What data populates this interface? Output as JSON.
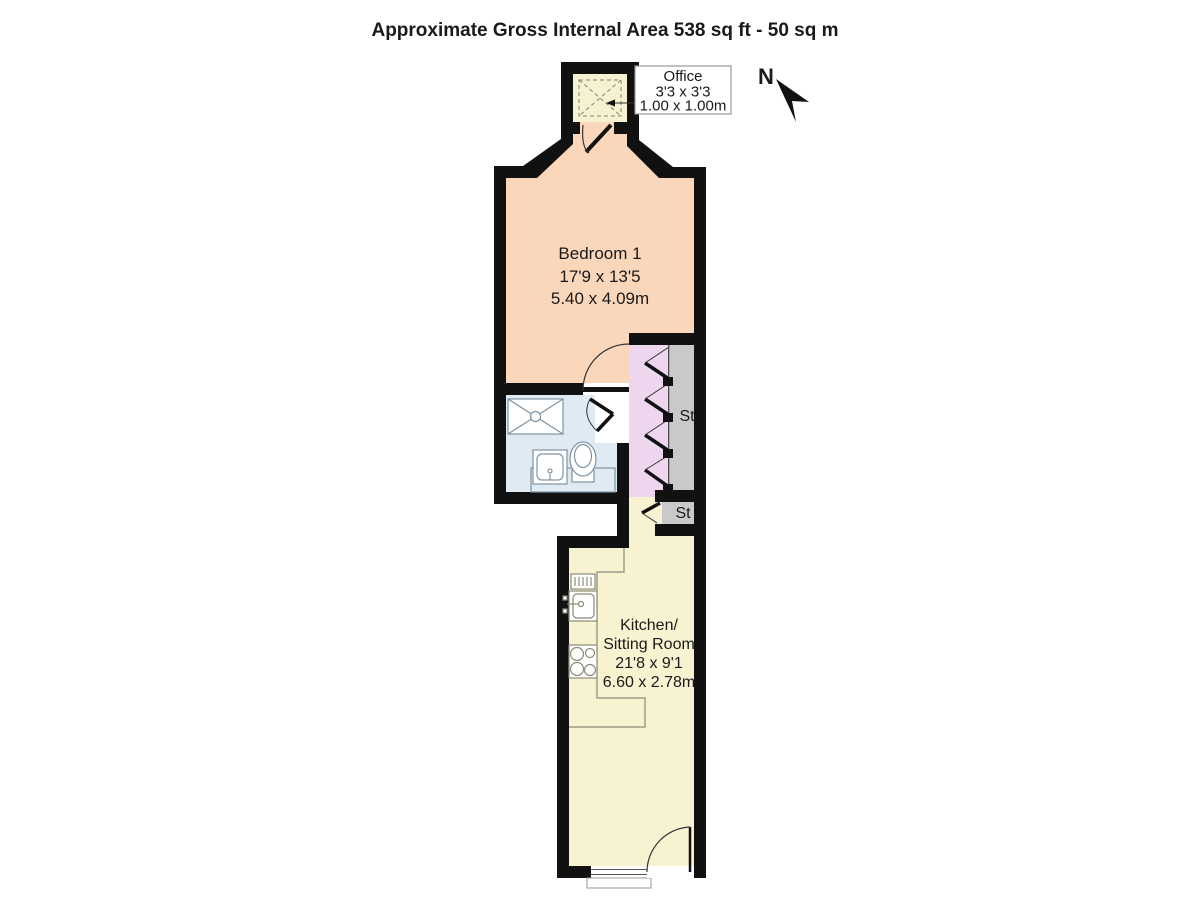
{
  "title": "Approximate Gross Internal Area 538 sq ft - 50 sq m",
  "compass": {
    "label": "N"
  },
  "callout": {
    "room": "Office",
    "dims_imperial": "3'3 x 3'3",
    "dims_metric": "1.00 x 1.00m"
  },
  "rooms": {
    "bedroom": {
      "name": "Bedroom 1",
      "dims_imperial": "17'9 x 13'5",
      "dims_metric": "5.40 x 4.09m"
    },
    "kitchen": {
      "name_line1": "Kitchen/",
      "name_line2": "Sitting Room",
      "dims_imperial": "21'8 x 9'1",
      "dims_metric": "6.60 x 2.78m"
    },
    "storage_large": {
      "label": "St"
    },
    "storage_small": {
      "label": "St"
    }
  },
  "colors": {
    "wall": "#111111",
    "bedroom": "#fad7ba",
    "office": "#f6f1d1",
    "kitchen": "#f7f2d0",
    "bathroom": "#dfeaf2",
    "hall": "#eed6ee",
    "storage": "#c9c9c9",
    "fixture_line": "#7f93a4",
    "counter_line": "#8a8a78"
  }
}
